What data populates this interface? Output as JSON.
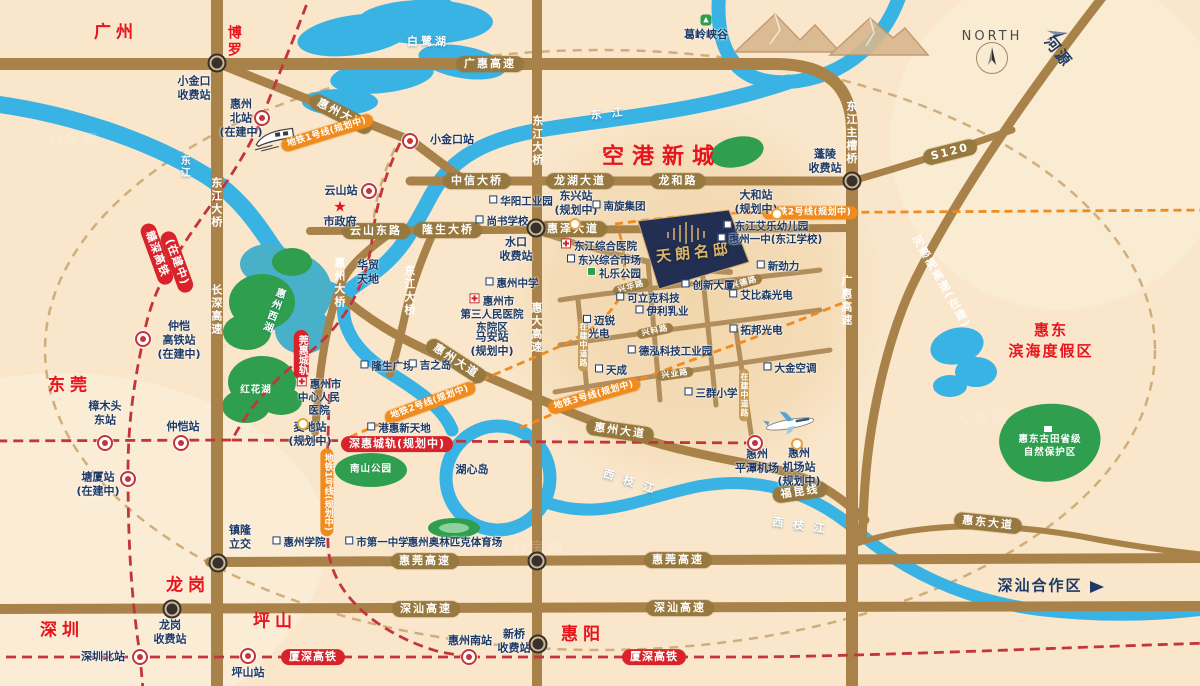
{
  "map_title": "惠州区位交通示意图",
  "colors": {
    "background": "#f9e6cb",
    "road": "#a9824a",
    "river": "#39b3e3",
    "green": "#2f9e4e",
    "rail_red": "#d8232b",
    "metro_orange": "#f08c1e",
    "city_red": "#e8131c",
    "label_navy": "#1e3a64",
    "project_navy": "#232f52",
    "project_gold": "#d9b56d"
  },
  "project": {
    "name": "天朗名邸"
  },
  "labels": [
    {
      "n": "city-guangzhou",
      "t": "广州",
      "x": 116,
      "y": 33,
      "k": "city"
    },
    {
      "n": "city-boluo",
      "t": "博罗",
      "x": 233,
      "y": 42,
      "k": "city-v"
    },
    {
      "n": "city-dongguan",
      "t": "东莞",
      "x": 70,
      "y": 386,
      "k": "city"
    },
    {
      "n": "city-shenzhen",
      "t": "深圳",
      "x": 62,
      "y": 631,
      "k": "city"
    },
    {
      "n": "city-longgang",
      "t": "龙岗",
      "x": 188,
      "y": 586,
      "k": "city"
    },
    {
      "n": "city-pingshan",
      "t": "坪山",
      "x": 275,
      "y": 622,
      "k": "city"
    },
    {
      "n": "city-huiyang",
      "t": "惠阳",
      "x": 583,
      "y": 635,
      "k": "city"
    },
    {
      "n": "airport-new-town",
      "t": "空港新城",
      "x": 662,
      "y": 157,
      "k": "city-lg"
    },
    {
      "n": "huidong-resort",
      "t": "惠东\n滨海度假区",
      "x": 1051,
      "y": 341,
      "k": "area-red"
    },
    {
      "n": "shenshan-zone",
      "t": "深汕合作区",
      "x": 1040,
      "y": 586,
      "k": "zone-navy"
    },
    {
      "n": "heyuan-direction",
      "t": "河源",
      "x": 1058,
      "y": 52,
      "k": "zone-navy",
      "r": 52
    },
    {
      "n": "north-label",
      "t": "NORTH",
      "x": 992,
      "y": 37,
      "k": "north"
    },
    {
      "n": "project-name",
      "t": "天朗名邸",
      "x": 694,
      "y": 253,
      "k": "proj",
      "r": -6
    },
    {
      "n": "road-guanghui-expwy",
      "t": "广惠高速",
      "x": 490,
      "y": 64,
      "k": "cap"
    },
    {
      "n": "road-huizhou-ave-n",
      "t": "惠州大道",
      "x": 341,
      "y": 114,
      "k": "cap",
      "r": 27
    },
    {
      "n": "road-zhongxin-bridge",
      "t": "中信大桥",
      "x": 477,
      "y": 181,
      "k": "cap"
    },
    {
      "n": "road-longhu-ave",
      "t": "龙湖大道",
      "x": 580,
      "y": 181,
      "k": "cap"
    },
    {
      "n": "road-longhe-rd",
      "t": "龙和路",
      "x": 678,
      "y": 181,
      "k": "cap"
    },
    {
      "n": "road-yunshan-east-rd",
      "t": "云山东路",
      "x": 376,
      "y": 231,
      "k": "cap"
    },
    {
      "n": "road-longsheng-bridge",
      "t": "隆生大桥",
      "x": 448,
      "y": 230,
      "k": "cap"
    },
    {
      "n": "road-huize-ave",
      "t": "惠泽大道",
      "x": 573,
      "y": 229,
      "k": "cap"
    },
    {
      "n": "road-huizhou-ave-mid",
      "t": "惠州大道",
      "x": 456,
      "y": 361,
      "k": "cap",
      "r": 33
    },
    {
      "n": "road-huizhou-ave-s",
      "t": "惠州大道",
      "x": 620,
      "y": 431,
      "k": "cap",
      "r": 8
    },
    {
      "n": "road-huiwan-expwy-w",
      "t": "惠莞高速",
      "x": 425,
      "y": 561,
      "k": "cap"
    },
    {
      "n": "road-huiwan-expwy-e",
      "t": "惠莞高速",
      "x": 678,
      "y": 560,
      "k": "cap"
    },
    {
      "n": "road-shenshan-expwy-w",
      "t": "深汕高速",
      "x": 426,
      "y": 609,
      "k": "cap"
    },
    {
      "n": "road-shenshan-expwy-e",
      "t": "深汕高速",
      "x": 680,
      "y": 608,
      "k": "cap"
    },
    {
      "n": "road-huidong-ave",
      "t": "惠东大道",
      "x": 988,
      "y": 523,
      "k": "cap",
      "r": 6
    },
    {
      "n": "road-s120",
      "t": "S120",
      "x": 950,
      "y": 152,
      "k": "cap",
      "r": -14
    },
    {
      "n": "rail-fukun-line",
      "t": "福昆线",
      "x": 800,
      "y": 492,
      "k": "cap",
      "r": -8
    },
    {
      "n": "road-xinghua-rd",
      "t": "兴华路",
      "x": 631,
      "y": 287,
      "k": "cap-sm",
      "r": -16
    },
    {
      "n": "road-xingde-rd",
      "t": "兴德路",
      "x": 744,
      "y": 283,
      "k": "cap-sm",
      "r": -16
    },
    {
      "n": "road-xingke-rd",
      "t": "兴科路",
      "x": 655,
      "y": 331,
      "k": "cap-sm",
      "r": -12
    },
    {
      "n": "road-xingye-rd",
      "t": "兴业路",
      "x": 675,
      "y": 374,
      "k": "cap-sm",
      "r": -8
    },
    {
      "n": "road-under-construction-w",
      "t": "在建中道路",
      "x": 583,
      "y": 345,
      "k": "cap-sm-v"
    },
    {
      "n": "road-under-construction-e",
      "t": "在建中道路",
      "x": 744,
      "y": 395,
      "k": "cap-sm-v"
    },
    {
      "n": "bridge-dongjiang-w",
      "t": "东江大桥",
      "x": 216,
      "y": 203,
      "k": "roadv"
    },
    {
      "n": "road-changshen-expwy",
      "t": "长深高速",
      "x": 216,
      "y": 310,
      "k": "roadv"
    },
    {
      "n": "bridge-dongjiang-n",
      "t": "东江大桥",
      "x": 537,
      "y": 141,
      "k": "roadv"
    },
    {
      "n": "bridge-dongjiang-mid",
      "t": "东江大桥",
      "x": 409,
      "y": 291,
      "k": "roadv"
    },
    {
      "n": "bridge-huizhou",
      "t": "惠州大桥",
      "x": 339,
      "y": 283,
      "k": "roadv"
    },
    {
      "n": "road-huida-expwy",
      "t": "惠大高速",
      "x": 536,
      "y": 328,
      "k": "roadv"
    },
    {
      "n": "road-guanghui-expwy-v",
      "t": "广惠高速",
      "x": 846,
      "y": 301,
      "k": "roadv"
    },
    {
      "n": "bridge-dongjiang-main",
      "t": "东江主槽桥",
      "x": 851,
      "y": 133,
      "k": "roadv"
    },
    {
      "n": "road-hehuiwan-expwy",
      "t": "河惠莞高速(在建)",
      "x": 941,
      "y": 282,
      "k": "roadv",
      "r": -30
    },
    {
      "n": "metro-line1-n",
      "t": "地铁1号线(规划中)",
      "x": 327,
      "y": 133,
      "k": "metro",
      "r": -17
    },
    {
      "n": "metro-line1-s",
      "t": "地铁1号线(规划中)",
      "x": 327,
      "y": 492,
      "k": "metro-v"
    },
    {
      "n": "metro-line2-e",
      "t": "地铁2号线(规划中)",
      "x": 810,
      "y": 213,
      "k": "metro"
    },
    {
      "n": "metro-line2-w",
      "t": "地铁2号线(规划中)",
      "x": 430,
      "y": 403,
      "k": "metro",
      "r": -20
    },
    {
      "n": "metro-line3",
      "t": "地铁3号线(规划中)",
      "x": 594,
      "y": 396,
      "k": "metro",
      "r": -16
    },
    {
      "n": "rail-ganshen-hsr",
      "t": "赣深高铁",
      "x": 157,
      "y": 254,
      "k": "rail",
      "r": 70
    },
    {
      "n": "rail-ganshen-status",
      "t": "(在建中)",
      "x": 177,
      "y": 262,
      "k": "rail",
      "r": 70
    },
    {
      "n": "rail-wanhui-intercity",
      "t": "莞惠城轨",
      "x": 301,
      "y": 355,
      "k": "rail-v"
    },
    {
      "n": "rail-shenhui-intercity",
      "t": "深惠城轨(规划中)",
      "x": 397,
      "y": 444,
      "k": "rail"
    },
    {
      "n": "rail-xiashen-hsr-w",
      "t": "厦深高铁",
      "x": 313,
      "y": 657,
      "k": "rail"
    },
    {
      "n": "rail-xiashen-hsr-e",
      "t": "厦深高铁",
      "x": 654,
      "y": 657,
      "k": "rail"
    },
    {
      "n": "sta-xiaojinkou-toll",
      "t": "小金口\n收费站",
      "x": 194,
      "y": 88,
      "k": "sta"
    },
    {
      "n": "sta-huizhou-north",
      "t": "惠州\n北站\n(在建中)",
      "x": 241,
      "y": 118,
      "k": "sta"
    },
    {
      "n": "sta-xiaojinkou",
      "t": "小金口站",
      "x": 452,
      "y": 140,
      "k": "sta"
    },
    {
      "n": "sta-yunshan",
      "t": "云山站",
      "x": 341,
      "y": 191,
      "k": "sta"
    },
    {
      "n": "gov-star",
      "t": "★",
      "x": 340,
      "y": 207,
      "k": "star"
    },
    {
      "n": "city-government",
      "t": "市政府",
      "x": 340,
      "y": 222,
      "k": "sta"
    },
    {
      "n": "huamao-tiandi",
      "t": "华贸\n天地",
      "x": 368,
      "y": 272,
      "k": "sta"
    },
    {
      "n": "sta-shuikou-toll",
      "t": "水口\n收费站",
      "x": 516,
      "y": 249,
      "k": "sta"
    },
    {
      "n": "huizhou-middle-school",
      "t": "惠州中学",
      "x": 512,
      "y": 284,
      "k": "fac",
      "icon": "sq"
    },
    {
      "n": "no3-hospital",
      "t": "惠州市\n第三人民医院\n东院区",
      "x": 492,
      "y": 314,
      "k": "fac",
      "icon": "cross"
    },
    {
      "n": "sta-maan",
      "t": "马安站\n(规划中)",
      "x": 492,
      "y": 344,
      "k": "sta"
    },
    {
      "n": "huayang-industrial-park",
      "t": "华阳工业园",
      "x": 521,
      "y": 202,
      "k": "fac",
      "icon": "sq"
    },
    {
      "n": "shangshu-school",
      "t": "尚书学校",
      "x": 502,
      "y": 222,
      "k": "fac",
      "icon": "sq"
    },
    {
      "n": "sta-dongxing",
      "t": "东兴站\n(规划中)",
      "x": 576,
      "y": 203,
      "k": "sta"
    },
    {
      "n": "nanxuan-group",
      "t": "南旋集团",
      "x": 619,
      "y": 207,
      "k": "fac",
      "icon": "sq"
    },
    {
      "n": "dongjiang-hospital",
      "t": "东江综合医院",
      "x": 599,
      "y": 246,
      "k": "fac",
      "icon": "cross"
    },
    {
      "n": "dongxing-market",
      "t": "东兴综合市场",
      "x": 604,
      "y": 261,
      "k": "fac",
      "icon": "sq"
    },
    {
      "n": "lile-park",
      "t": "礼乐公园",
      "x": 614,
      "y": 274,
      "k": "fac",
      "icon": "grn"
    },
    {
      "n": "sta-dahe",
      "t": "大和站\n(规划中)",
      "x": 756,
      "y": 202,
      "k": "sta"
    },
    {
      "n": "aile-kindergarten",
      "t": "东江艾乐幼儿园",
      "x": 766,
      "y": 227,
      "k": "fac",
      "icon": "sq"
    },
    {
      "n": "huizhou-no1-school",
      "t": "惠州一中(东江学校)",
      "x": 770,
      "y": 240,
      "k": "fac",
      "icon": "sq"
    },
    {
      "n": "xinjinli",
      "t": "新劲力",
      "x": 778,
      "y": 267,
      "k": "fac",
      "icon": "sq"
    },
    {
      "n": "chuangxin-tower",
      "t": "创新大厦",
      "x": 708,
      "y": 286,
      "k": "fac",
      "icon": "sq"
    },
    {
      "n": "kelike-tech",
      "t": "可立克科技",
      "x": 648,
      "y": 299,
      "k": "fac",
      "icon": "sq"
    },
    {
      "n": "aibisen-optoelectronics",
      "t": "艾比森光电",
      "x": 761,
      "y": 296,
      "k": "fac",
      "icon": "sq"
    },
    {
      "n": "yili-dairy",
      "t": "伊利乳业",
      "x": 662,
      "y": 312,
      "k": "fac",
      "icon": "sq"
    },
    {
      "n": "mairui-optoelectronics",
      "t": "迈锐\n光电",
      "x": 599,
      "y": 328,
      "k": "fac",
      "icon": "sq"
    },
    {
      "n": "tuobang-optoelectronics",
      "t": "拓邦光电",
      "x": 756,
      "y": 331,
      "k": "fac",
      "icon": "sq"
    },
    {
      "n": "dehong-tech-park",
      "t": "德泓科技工业园",
      "x": 670,
      "y": 352,
      "k": "fac",
      "icon": "sq"
    },
    {
      "n": "tiancheng",
      "t": "天成",
      "x": 611,
      "y": 371,
      "k": "fac",
      "icon": "sq"
    },
    {
      "n": "daikin-ac",
      "t": "大金空调",
      "x": 790,
      "y": 369,
      "k": "fac",
      "icon": "sq"
    },
    {
      "n": "sanqun-primary-school",
      "t": "三群小学",
      "x": 711,
      "y": 394,
      "k": "fac",
      "icon": "sq"
    },
    {
      "n": "sta-pingtan-airport",
      "t": "惠州\n平潭机场",
      "x": 757,
      "y": 461,
      "k": "sta"
    },
    {
      "n": "sta-airport-station",
      "t": "惠州\n机场站\n(规划中)",
      "x": 799,
      "y": 467,
      "k": "sta"
    },
    {
      "n": "longsheng-plaza",
      "t": "隆生广场",
      "x": 387,
      "y": 367,
      "k": "fac",
      "icon": "sq"
    },
    {
      "n": "jusco",
      "t": "吉之岛",
      "x": 430,
      "y": 366,
      "k": "fac",
      "icon": "sq"
    },
    {
      "n": "central-hospital",
      "t": "惠州市\n中心人民\n医院",
      "x": 319,
      "y": 397,
      "k": "fac",
      "icon": "cross"
    },
    {
      "n": "ganghui-new-world",
      "t": "港惠新天地",
      "x": 399,
      "y": 429,
      "k": "fac",
      "icon": "sq"
    },
    {
      "n": "sta-maidi",
      "t": "麦地站\n(规划中)",
      "x": 310,
      "y": 434,
      "k": "sta"
    },
    {
      "n": "huxin-island",
      "t": "湖心岛",
      "x": 472,
      "y": 470,
      "k": "sta"
    },
    {
      "n": "huizhou-university",
      "t": "惠州学院",
      "x": 299,
      "y": 543,
      "k": "fac",
      "icon": "sq"
    },
    {
      "n": "no1-middle-school",
      "t": "市第一中学",
      "x": 377,
      "y": 543,
      "k": "fac",
      "icon": "sq"
    },
    {
      "n": "olympic-stadium",
      "t": "惠州奥林匹克体育场",
      "x": 455,
      "y": 543,
      "k": "fac"
    },
    {
      "n": "sta-zhongkai-hsr",
      "t": "仲恺\n高铁站\n(在建中)",
      "x": 179,
      "y": 340,
      "k": "sta"
    },
    {
      "n": "sta-zhangmutou-east",
      "t": "樟木头\n东站",
      "x": 105,
      "y": 413,
      "k": "sta"
    },
    {
      "n": "sta-zhongkai",
      "t": "仲恺站",
      "x": 183,
      "y": 427,
      "k": "sta"
    },
    {
      "n": "sta-tangxia",
      "t": "塘厦站\n(在建中)",
      "x": 98,
      "y": 484,
      "k": "sta"
    },
    {
      "n": "sta-shenzhen-north",
      "t": "深圳北站",
      "x": 103,
      "y": 657,
      "k": "sta"
    },
    {
      "n": "sta-longgang-toll",
      "t": "龙岗\n收费站",
      "x": 170,
      "y": 632,
      "k": "sta"
    },
    {
      "n": "zhenlong-interchange",
      "t": "镇隆\n立交",
      "x": 240,
      "y": 537,
      "k": "sta"
    },
    {
      "n": "sta-pingshan",
      "t": "坪山站",
      "x": 248,
      "y": 673,
      "k": "sta"
    },
    {
      "n": "sta-huizhou-south",
      "t": "惠州南站",
      "x": 470,
      "y": 641,
      "k": "sta"
    },
    {
      "n": "sta-xinqiao-toll",
      "t": "新桥\n收费站",
      "x": 514,
      "y": 641,
      "k": "sta"
    },
    {
      "n": "sta-pengling-toll",
      "t": "蓬陵\n收费站",
      "x": 825,
      "y": 161,
      "k": "sta"
    },
    {
      "n": "geling-canyon",
      "t": "葛岭峡谷",
      "x": 706,
      "y": 35,
      "k": "sta"
    },
    {
      "n": "bailu-lake",
      "t": "白鹭湖",
      "x": 428,
      "y": 42,
      "k": "water"
    },
    {
      "n": "dongjiang-river-e",
      "t": "东 江",
      "x": 608,
      "y": 114,
      "k": "water",
      "r": -6
    },
    {
      "n": "dongjiang-river-w",
      "t": "东江",
      "x": 183,
      "y": 167,
      "k": "water-v"
    },
    {
      "n": "xizhijiang-river-w",
      "t": "西 枝 江",
      "x": 630,
      "y": 482,
      "k": "water",
      "r": 18
    },
    {
      "n": "xizhijiang-river-e",
      "t": "西 枝 江",
      "x": 800,
      "y": 526,
      "k": "water",
      "r": 8
    },
    {
      "n": "west-lake",
      "t": "惠州西湖",
      "x": 272,
      "y": 310,
      "k": "water-v",
      "r": 20
    },
    {
      "n": "honghua-lake",
      "t": "红花湖",
      "x": 256,
      "y": 391,
      "k": "green-t"
    },
    {
      "n": "nanshan-park",
      "t": "南山公园",
      "x": 371,
      "y": 470,
      "k": "green-t"
    },
    {
      "n": "gutian-reserve",
      "t": "惠东古田省级\n自然保护区",
      "x": 1050,
      "y": 447,
      "k": "green-t"
    },
    {
      "n": "watermark-1",
      "t": "Q房网",
      "x": 75,
      "y": 140,
      "k": "wm"
    },
    {
      "n": "watermark-2",
      "t": "Q房网",
      "x": 540,
      "y": 548,
      "k": "wm"
    },
    {
      "n": "watermark-3",
      "t": "Q房网",
      "x": 985,
      "y": 418,
      "k": "wm"
    }
  ],
  "icons": [
    {
      "n": "huizhou-north-station",
      "x": 262,
      "y": 118,
      "k": "ic-rail"
    },
    {
      "n": "xiaojinkou-station",
      "x": 410,
      "y": 141,
      "k": "ic-rail"
    },
    {
      "n": "yunshan-station",
      "x": 369,
      "y": 191,
      "k": "ic-rail"
    },
    {
      "n": "zhongkai-hsr-station",
      "x": 143,
      "y": 339,
      "k": "ic-rail"
    },
    {
      "n": "zhangmutou-east-station",
      "x": 105,
      "y": 443,
      "k": "ic-rail"
    },
    {
      "n": "zhongkai-station",
      "x": 181,
      "y": 443,
      "k": "ic-rail"
    },
    {
      "n": "tangxia-station",
      "x": 128,
      "y": 479,
      "k": "ic-rail"
    },
    {
      "n": "shenzhen-north-station",
      "x": 140,
      "y": 657,
      "k": "ic-rail"
    },
    {
      "n": "pingshan-station",
      "x": 248,
      "y": 656,
      "k": "ic-rail"
    },
    {
      "n": "huizhou-south-station",
      "x": 469,
      "y": 657,
      "k": "ic-rail"
    },
    {
      "n": "pingtan-airport-station",
      "x": 755,
      "y": 443,
      "k": "ic-rail"
    },
    {
      "n": "dahe-stop",
      "x": 777,
      "y": 214,
      "k": "ic-stop"
    },
    {
      "n": "dongxing-stop",
      "x": 575,
      "y": 224,
      "k": "ic-stop"
    },
    {
      "n": "maidi-stop",
      "x": 303,
      "y": 424,
      "k": "ic-stop"
    },
    {
      "n": "airport-stop",
      "x": 797,
      "y": 444,
      "k": "ic-stop"
    },
    {
      "n": "xiaojinkou-toll-junction",
      "x": 217,
      "y": 63,
      "k": "ic-junc"
    },
    {
      "n": "pengling-toll-junction",
      "x": 852,
      "y": 181,
      "k": "ic-junc"
    },
    {
      "n": "shuikou-junction",
      "x": 536,
      "y": 228,
      "k": "ic-junc"
    },
    {
      "n": "zhenlong-junction",
      "x": 218,
      "y": 563,
      "k": "ic-junc"
    },
    {
      "n": "huiwan-junction",
      "x": 537,
      "y": 561,
      "k": "ic-junc"
    },
    {
      "n": "longgang-toll-junction",
      "x": 172,
      "y": 609,
      "k": "ic-junc"
    },
    {
      "n": "xinqiao-toll-junction",
      "x": 538,
      "y": 644,
      "k": "ic-junc"
    },
    {
      "n": "shenshan-zone-arrow",
      "x": 1097,
      "y": 587,
      "k": "ic-arrow"
    },
    {
      "n": "geling-canyon-tree",
      "x": 706,
      "y": 20,
      "k": "ic-tree",
      "g": "▲"
    },
    {
      "n": "gutian-reserve-building",
      "x": 1048,
      "y": 429,
      "k": "ic-bld"
    }
  ]
}
